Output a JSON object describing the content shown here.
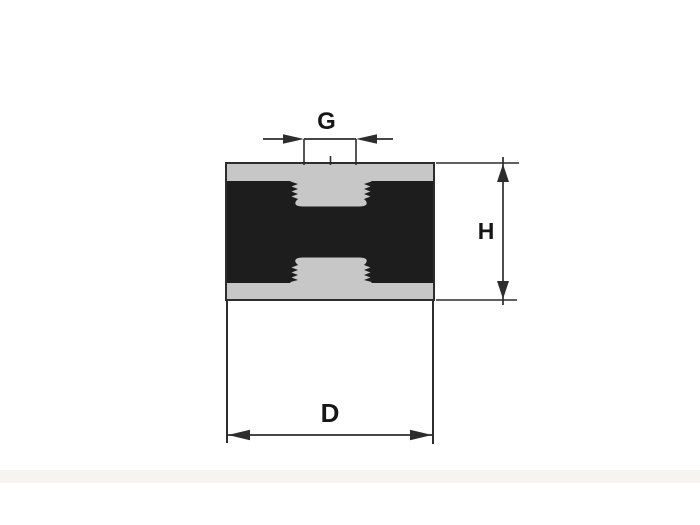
{
  "labels": {
    "thread_diameter": "G",
    "height": "H",
    "outer_diameter": "D"
  },
  "colors": {
    "line": "#2d2d2d",
    "rubber": "#1d1d1d",
    "plate": "#c7c7c7",
    "background": "#ffffff",
    "shadow_band": "#f5f4f1",
    "label_text": "#161616"
  }
}
